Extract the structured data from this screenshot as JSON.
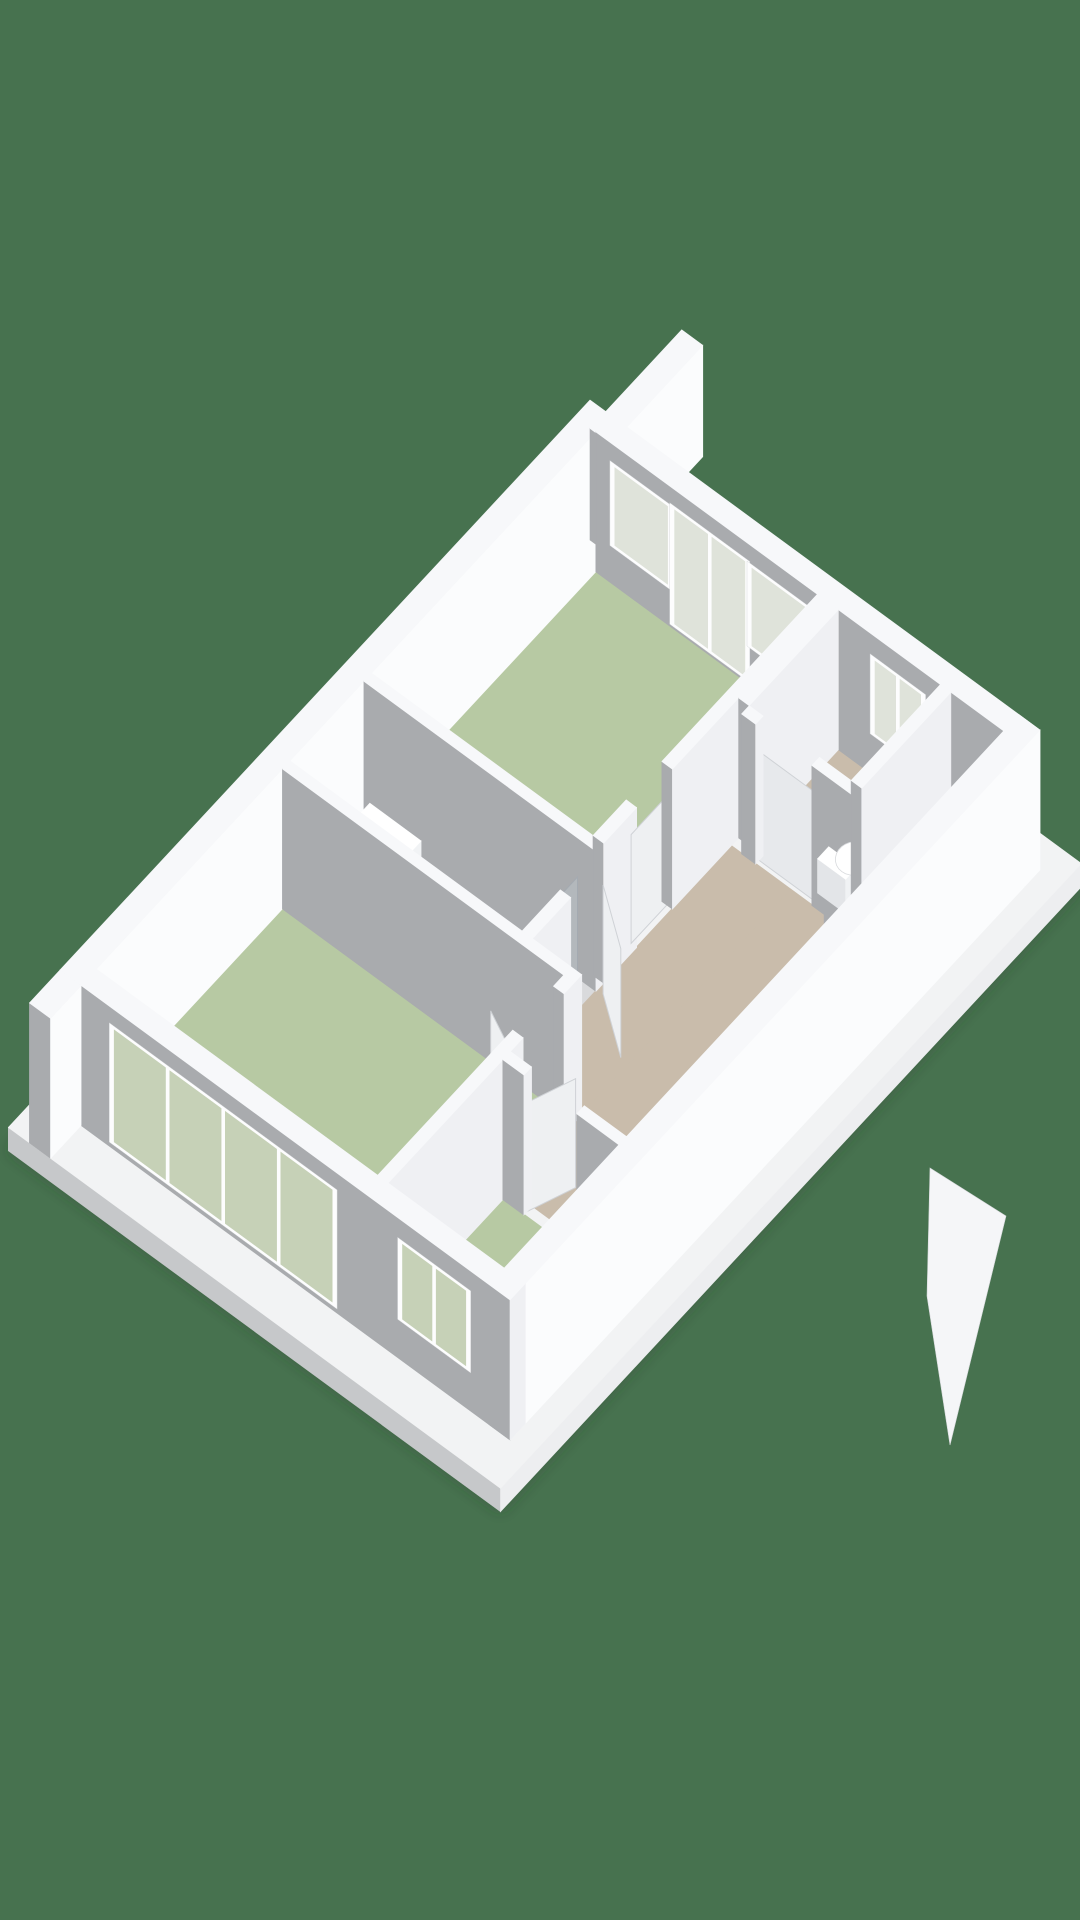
{
  "canvas": {
    "width": 1080,
    "height": 1920,
    "background": "#47724f"
  },
  "projection": {
    "origin": [
      60,
      1110
    ],
    "eu": [
      50.96,
      -54.81
    ],
    "ev": [
      70.31,
      51.56
    ],
    "ez": [
      0,
      -51.85
    ]
  },
  "palette": {
    "bg": "#47724f",
    "green": "#b7c9a3",
    "tan": "#c9bcab",
    "bath": "#d9dadc",
    "top": "#f7f8fa",
    "light": "#eff0f3",
    "bright": "#fbfcfd",
    "gray": "#a9abae",
    "ptop": "#f2f3f4",
    "pside": "#c6c8ca",
    "pfront": "#edeef0",
    "glassG": "#c6d1b7",
    "glassP": "#dfe3da",
    "frame": "#fdfdfe",
    "navy": "#2b3440",
    "navy2": "#3a4450",
    "white": "#ffffff",
    "chrome": "#a4aab1",
    "leaf": "#eef0f2",
    "ledge": "#cfd2d6",
    "shadow": "rgba(42,60,47,0.35)"
  },
  "scene": {
    "items": [
      {
        "name": "ground-shadow",
        "type": "screenpoly",
        "pts": [
          [
            8,
            1151
          ],
          [
            589,
            526
          ],
          [
            1082,
            887
          ],
          [
            501,
            1512
          ]
        ],
        "fill": "$shadow",
        "blur": true
      },
      {
        "name": "plinth",
        "type": "box",
        "u0": -0.6,
        "u1": 10.8,
        "v0": -0.3,
        "v1": 6.7,
        "z0": -0.45,
        "z1": 0,
        "c": [
          "$ptop",
          "$pside",
          "$pfront"
        ]
      },
      {
        "name": "floor-bedroom-left",
        "type": "floor",
        "r": [
          0.3,
          3.95,
          0.3,
          4.3
        ],
        "fill": "$green"
      },
      {
        "name": "floor-living-top",
        "type": "floor",
        "r": [
          5.7,
          10.1,
          0.3,
          3.45
        ],
        "fill": "$green"
      },
      {
        "name": "floor-bedroom-small",
        "type": "floor",
        "r": [
          0.3,
          2.55,
          4.45,
          6.1
        ],
        "fill": "$green"
      },
      {
        "name": "floor-bathroom",
        "type": "floor",
        "r": [
          4.1,
          5.55,
          0.3,
          3.6
        ],
        "fill": "$bath"
      },
      {
        "name": "floor-hall-a",
        "type": "floor",
        "r": [
          2.7,
          8.2,
          4.45,
          6.1
        ],
        "fill": "$tan"
      },
      {
        "name": "floor-hall-b",
        "type": "floor",
        "r": [
          4.1,
          8.2,
          3.6,
          4.45
        ],
        "fill": "$tan"
      },
      {
        "name": "floor-hall-c",
        "type": "floor",
        "r": [
          8.2,
          10.1,
          5.35,
          6.1
        ],
        "fill": "$tan"
      },
      {
        "name": "floor-wc",
        "type": "floor",
        "r": [
          8.35,
          10.1,
          3.75,
          5.2
        ],
        "fill": "$tan"
      },
      {
        "name": "wall-nw",
        "type": "box",
        "u0": 0,
        "u1": 10.4,
        "v0": 0,
        "v1": 0.3,
        "c": [
          "$top",
          "$gray",
          "$bright"
        ]
      },
      {
        "name": "wall-nw-stub",
        "type": "box",
        "u0": 10.4,
        "u1": 12.2,
        "v0": 0,
        "v1": 0.3,
        "z1": 2.15,
        "c": [
          "$top",
          "$gray",
          "$bright"
        ]
      },
      {
        "name": "wall-ne",
        "type": "box",
        "u0": 10.1,
        "u1": 10.4,
        "v0": 0.3,
        "v1": 6.4
      },
      {
        "name": "window-living-1",
        "type": "window",
        "wall": "ne",
        "span": [
          0.6,
          1.35
        ],
        "z": [
          0.85,
          2.35
        ],
        "panes": 1,
        "glass": "$glassP"
      },
      {
        "name": "door-living-balcony",
        "type": "window",
        "wall": "ne",
        "span": [
          1.45,
          2.45
        ],
        "z": [
          0.18,
          2.38
        ],
        "panes": 2,
        "glass": "$glassP"
      },
      {
        "name": "window-living-2",
        "type": "window",
        "wall": "ne",
        "span": [
          2.55,
          3.3
        ],
        "z": [
          0.85,
          2.35
        ],
        "panes": 1,
        "glass": "$glassP"
      },
      {
        "name": "window-wc",
        "type": "window",
        "wall": "ne",
        "span": [
          4.3,
          4.95
        ],
        "z": [
          0.9,
          2.3
        ],
        "panes": 2,
        "glass": "$glassP"
      },
      {
        "name": "wall-bathroom-ne",
        "type": "box",
        "u0": 5.55,
        "u1": 5.7,
        "v0": 0.3,
        "v1": 3.6
      },
      {
        "name": "wall-living-se-1",
        "type": "box",
        "u0": 5.7,
        "u1": 6.35,
        "v0": 3.45,
        "v1": 3.6
      },
      {
        "name": "door-living-leaf",
        "type": "quad",
        "pts": [
          [
            6.35,
            3.52,
            0
          ],
          [
            7.05,
            3.52,
            0
          ],
          [
            7.05,
            3.52,
            2.1
          ],
          [
            6.35,
            3.52,
            2.1
          ]
        ],
        "fill": "$leaf",
        "stroke": "$ledge"
      },
      {
        "name": "wall-living-se-2",
        "type": "box",
        "u0": 7.05,
        "u1": 10.1,
        "v0": 3.45,
        "v1": 3.6
      },
      {
        "name": "shower-unit",
        "type": "box",
        "u0": 4.2,
        "u1": 5.5,
        "v0": 0.42,
        "v1": 1.15,
        "z0": 0,
        "z1": 0.52,
        "c": [
          "$white",
          "#e7e9eb",
          "#f1f3f5"
        ]
      },
      {
        "name": "toilet-bathroom-tank",
        "type": "box",
        "u0": 4.22,
        "u1": 4.5,
        "v0": 1.32,
        "v1": 1.72,
        "z0": 0,
        "z1": 0.6,
        "c": [
          "$white",
          "#e3e5e8",
          "#f0f2f4"
        ]
      },
      {
        "name": "toilet-bathroom-bowl",
        "type": "ellipse",
        "c": [
          4.74,
          1.52
        ],
        "z": 0.42,
        "rx": 0.27,
        "ry": 0.21,
        "fill": "$white",
        "stroke": "#d8dadd"
      },
      {
        "name": "vanity-cabinet",
        "type": "box",
        "u0": 4.22,
        "u1": 4.88,
        "v0": 1.9,
        "v1": 3.22,
        "z0": 0,
        "z1": 0.78,
        "c": [
          "$navy",
          "$navy",
          "$navy2"
        ]
      },
      {
        "name": "vanity-counter",
        "type": "box",
        "u0": 4.14,
        "u1": 4.96,
        "v0": 1.82,
        "v1": 3.28,
        "z0": 0.78,
        "z1": 0.9,
        "c": [
          "$white",
          "#e4e6e9",
          "#f2f4f6"
        ]
      },
      {
        "name": "vanity-basin-1",
        "type": "box",
        "u0": 4.28,
        "u1": 4.82,
        "v0": 1.96,
        "v1": 2.48,
        "z0": 0.9,
        "z1": 1.04,
        "c": [
          "#f3f5f6",
          "#e0e2e5",
          "#eef0f2"
        ]
      },
      {
        "name": "vanity-basin-2",
        "type": "box",
        "u0": 4.28,
        "u1": 4.82,
        "v0": 2.6,
        "v1": 3.12,
        "z0": 0.9,
        "z1": 1.04,
        "c": [
          "#f3f5f6",
          "#e0e2e5",
          "#eef0f2"
        ]
      },
      {
        "name": "faucet-1",
        "type": "box",
        "u0": 4.24,
        "u1": 4.3,
        "v0": 2.18,
        "v1": 2.26,
        "z0": 1.04,
        "z1": 1.3,
        "c": [
          "$chrome",
          "#8f959c",
          "$chrome"
        ]
      },
      {
        "name": "faucet-2",
        "type": "box",
        "u0": 4.24,
        "u1": 4.3,
        "v0": 2.82,
        "v1": 2.9,
        "z0": 1.04,
        "z1": 1.3,
        "c": [
          "$chrome",
          "#8f959c",
          "$chrome"
        ]
      },
      {
        "name": "shower-glass-screen",
        "type": "quad",
        "pts": [
          [
            4.3,
            3.36,
            0
          ],
          [
            5.52,
            3.36,
            0
          ],
          [
            5.52,
            3.36,
            2.0
          ],
          [
            4.3,
            3.36,
            2.0
          ]
        ],
        "fill": "rgba(196,206,211,0.38)",
        "stroke": "$chrome"
      },
      {
        "name": "wall-bathroom-se",
        "type": "box",
        "u0": 4.1,
        "u1": 4.85,
        "v0": 3.6,
        "v1": 3.75
      },
      {
        "name": "door-bathroom-leaf",
        "type": "quad",
        "pts": [
          [
            5.58,
            3.68,
            0
          ],
          [
            5.03,
            4.33,
            0
          ],
          [
            5.03,
            4.33,
            2.1
          ],
          [
            5.58,
            3.68,
            2.1
          ]
        ],
        "fill": "$leaf",
        "stroke": "$ledge"
      },
      {
        "name": "wall-bedroom-left-ne",
        "type": "box",
        "u0": 3.95,
        "u1": 4.1,
        "v0": 0.3,
        "v1": 4.45
      },
      {
        "name": "door-bedroom-left-leaf",
        "type": "quad",
        "pts": [
          [
            2.95,
            4.37,
            0
          ],
          [
            3.32,
            3.72,
            0
          ],
          [
            3.32,
            3.72,
            2.1
          ],
          [
            2.95,
            4.37,
            2.1
          ]
        ],
        "fill": "$leaf",
        "stroke": "$ledge"
      },
      {
        "name": "wall-bedroom-left-se-1",
        "type": "box",
        "u0": 0.3,
        "u1": 2.95,
        "v0": 4.3,
        "v1": 4.45
      },
      {
        "name": "wall-bedroom-left-se-2",
        "type": "box",
        "u0": 3.75,
        "u1": 3.95,
        "v0": 4.3,
        "v1": 4.45
      },
      {
        "name": "door-bedroom-small-leaf",
        "type": "quad",
        "pts": [
          [
            2.62,
            4.75,
            0
          ],
          [
            3.26,
            4.97,
            0
          ],
          [
            3.26,
            4.97,
            2.1
          ],
          [
            2.62,
            4.75,
            2.1
          ]
        ],
        "fill": "$leaf",
        "stroke": "$ledge"
      },
      {
        "name": "wall-bedroom-small-ne-1",
        "type": "box",
        "u0": 2.55,
        "u1": 2.7,
        "v0": 4.45,
        "v1": 4.75
      },
      {
        "name": "wall-bedroom-small-ne-2",
        "type": "box",
        "u0": 2.55,
        "u1": 2.7,
        "v0": 5.5,
        "v1": 6.1
      },
      {
        "name": "closet-wall-1",
        "type": "box",
        "u0": 7.75,
        "u1": 8.2,
        "v0": 5.25,
        "v1": 5.4
      },
      {
        "name": "closet-wall-2",
        "type": "box",
        "u0": 7.75,
        "u1": 7.9,
        "v0": 5.4,
        "v1": 6.1
      },
      {
        "name": "wall-wc-nw",
        "type": "box",
        "u0": 8.35,
        "u1": 10.1,
        "v0": 3.6,
        "v1": 3.75
      },
      {
        "name": "door-wc-leaf",
        "type": "quad",
        "pts": [
          [
            8.27,
            3.95,
            0
          ],
          [
            8.27,
            4.75,
            0
          ],
          [
            8.27,
            4.75,
            2.1
          ],
          [
            8.27,
            3.95,
            2.1
          ]
        ],
        "fill": "#e7e9ec",
        "stroke": "$ledge"
      },
      {
        "name": "wall-wc-sw-1",
        "type": "box",
        "u0": 8.2,
        "u1": 8.35,
        "v0": 3.75,
        "v1": 3.95
      },
      {
        "name": "wall-wc-sw-2",
        "type": "box",
        "u0": 8.2,
        "u1": 8.35,
        "v0": 4.75,
        "v1": 5.35
      },
      {
        "name": "toilet-wc-tank",
        "type": "box",
        "u0": 8.38,
        "u1": 8.6,
        "v0": 4.7,
        "v1": 5.1,
        "z0": 0,
        "z1": 0.66,
        "c": [
          "$white",
          "#e3e5e8",
          "#f0f2f4"
        ]
      },
      {
        "name": "toilet-wc-bowl",
        "type": "ellipse",
        "c": [
          8.82,
          4.9
        ],
        "z": 0.4,
        "rx": 0.24,
        "ry": 0.2,
        "fill": "$white",
        "stroke": "#d8dadd"
      },
      {
        "name": "wall-wc-se",
        "type": "box",
        "u0": 8.35,
        "u1": 10.1,
        "v0": 5.2,
        "v1": 5.35
      },
      {
        "name": "hall-desk-leg-1",
        "type": "box",
        "u0": 6.74,
        "u1": 6.8,
        "v0": 5.86,
        "v1": 5.92,
        "z0": 0,
        "z1": 0.72,
        "c": [
          "#dadce0",
          "#c9ccd1",
          "#d5d8db"
        ]
      },
      {
        "name": "hall-desk-leg-2",
        "type": "box",
        "u0": 7.46,
        "u1": 7.52,
        "v0": 5.86,
        "v1": 5.92,
        "z0": 0,
        "z1": 0.72,
        "c": [
          "#dadce0",
          "#c9ccd1",
          "#d5d8db"
        ]
      },
      {
        "name": "hall-desk-top",
        "type": "box",
        "u0": 6.68,
        "u1": 7.58,
        "v0": 5.4,
        "v1": 5.98,
        "z0": 0.72,
        "z1": 0.8,
        "c": [
          "$white",
          "#e6e8ea",
          "#f2f4f6"
        ]
      },
      {
        "name": "hall-desk-item",
        "type": "box",
        "u0": 7.02,
        "u1": 7.26,
        "v0": 5.54,
        "v1": 5.78,
        "z0": 0.8,
        "z1": 0.97,
        "c": [
          "#eceef0",
          "#dcdee2",
          "#e7e9ec"
        ]
      },
      {
        "name": "wall-se",
        "type": "box",
        "u0": 0,
        "u1": 10.4,
        "v0": 6.1,
        "v1": 6.4,
        "c": [
          "$top",
          "$gray",
          "$bright"
        ]
      },
      {
        "name": "entry-door-open",
        "type": "screenpoly",
        "pts": [
          [
            930,
            1168
          ],
          [
            1006,
            1216
          ],
          [
            950,
            1445
          ],
          [
            927,
            1296
          ]
        ],
        "fill": "#f5f6f8",
        "stroke": "#d8dadd"
      },
      {
        "name": "wall-sw",
        "type": "box",
        "u0": 0,
        "u1": 0.3,
        "v0": 0.3,
        "v1": 6.4
      },
      {
        "name": "wall-sw-stub",
        "type": "box",
        "u0": -0.6,
        "u1": 0,
        "v0": 0,
        "v1": 0.3,
        "c": [
          "$top",
          "$gray",
          "$bright"
        ]
      },
      {
        "name": "window-bedroom-left",
        "type": "window",
        "wall": "sw",
        "span": [
          0.8,
          3.9
        ],
        "z": [
          0.22,
          2.38
        ],
        "panes": 4,
        "glass": "$glassG"
      },
      {
        "name": "window-bedroom-small",
        "type": "window",
        "wall": "sw",
        "span": [
          4.9,
          5.8
        ],
        "z": [
          0.88,
          2.32
        ],
        "panes": 2,
        "glass": "$glassG"
      }
    ]
  }
}
